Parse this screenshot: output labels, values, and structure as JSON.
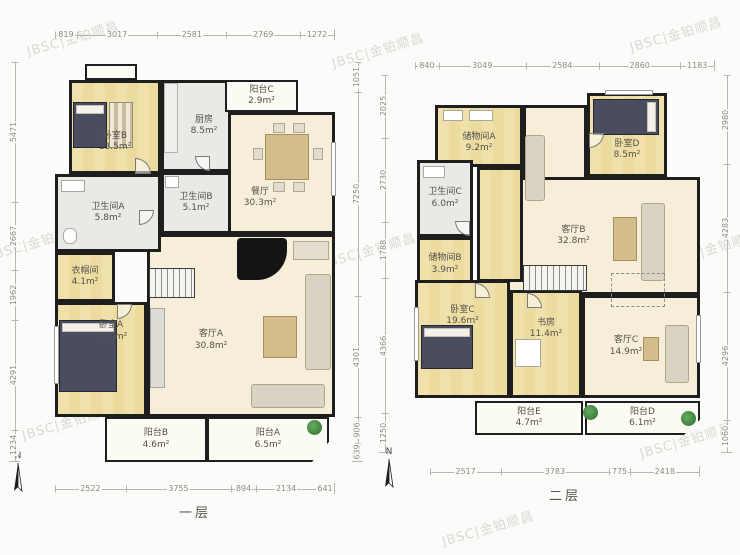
{
  "watermark": {
    "text": "JBSC|金铂顺昌"
  },
  "floor1": {
    "label": "一层",
    "north_label": "N",
    "rooms": [
      {
        "name": "卧室B",
        "area": "13.5m²"
      },
      {
        "name": "厨房",
        "area": "8.5m²"
      },
      {
        "name": "阳台C",
        "area": "2.9m²"
      },
      {
        "name": "餐厅",
        "area": "30.3m²"
      },
      {
        "name": "卫生间A",
        "area": "5.8m²"
      },
      {
        "name": "卫生间B",
        "area": "5.1m²"
      },
      {
        "name": "衣帽间",
        "area": "4.1m²"
      },
      {
        "name": "卧室A",
        "area": "17.7m²"
      },
      {
        "name": "客厅A",
        "area": "30.8m²"
      },
      {
        "name": "阳台B",
        "area": "4.6m²"
      },
      {
        "name": "阳台A",
        "area": "6.5m²"
      }
    ],
    "dims_top": [
      "819",
      "3017",
      "2581",
      "2769",
      "1272"
    ],
    "dims_left": [
      "5471",
      "2667",
      "1962",
      "4291",
      "1234"
    ],
    "dims_right": [
      "1051",
      "7250",
      "4301",
      "906",
      "639"
    ],
    "dims_bottom": [
      "2522",
      "3755",
      "894",
      "2134",
      "641"
    ]
  },
  "floor2": {
    "label": "二层",
    "north_label": "N",
    "rooms": [
      {
        "name": "储物间A",
        "area": "9.2m²"
      },
      {
        "name": "卧室D",
        "area": "8.5m²"
      },
      {
        "name": "卫生间C",
        "area": "6.0m²"
      },
      {
        "name": "储物间B",
        "area": "3.9m²"
      },
      {
        "name": "客厅B",
        "area": "32.8m²"
      },
      {
        "name": "卧室C",
        "area": "19.6m²"
      },
      {
        "name": "书房",
        "area": "11.4m²"
      },
      {
        "name": "客厅C",
        "area": "14.9m²"
      },
      {
        "name": "阳台E",
        "area": "4.7m²"
      },
      {
        "name": "阳台D",
        "area": "6.1m²"
      }
    ],
    "dims_top": [
      "840",
      "3049",
      "2584",
      "2860",
      "1183"
    ],
    "dims_left": [
      "2025",
      "2730",
      "1788",
      "4366",
      "1250"
    ],
    "dims_right": [
      "2980",
      "4283",
      "4296",
      "1060"
    ],
    "dims_bottom": [
      "2517",
      "3783",
      "775",
      "2418"
    ]
  }
}
